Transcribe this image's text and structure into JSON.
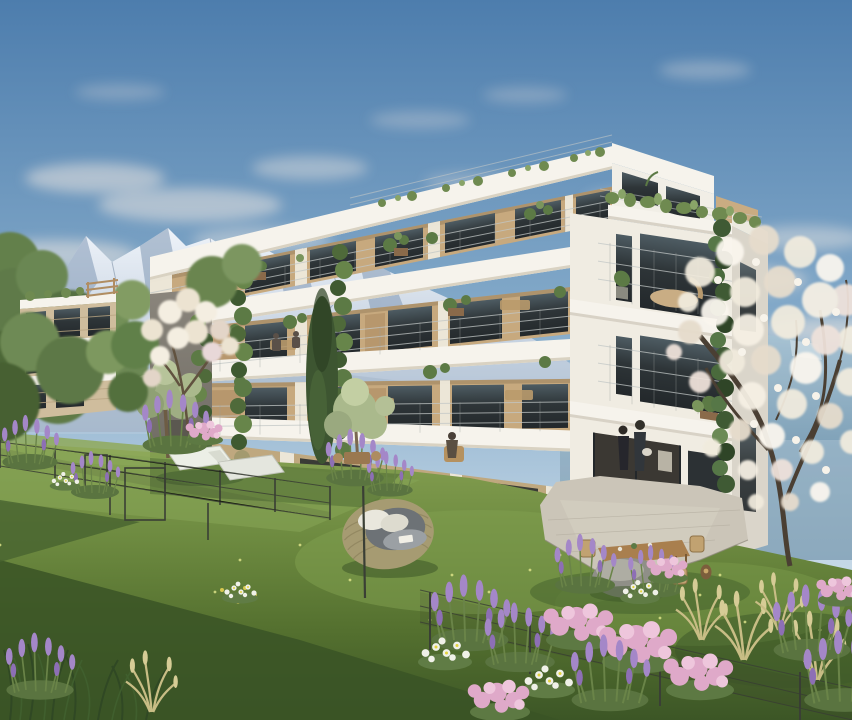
{
  "scene": {
    "description": "Architectural rendering of a modern four-storey apartment building with wood-clad balconies, rooftop terrace plants, an alpine snow mountain backdrop, a flowering meadow garden with wire fences, sun loungers, a rattan egg chair and a blossoming tree.",
    "palette": {
      "sky_top": "#4d7dad",
      "sky_mid": "#85abca",
      "sky_low": "#c4d7e6",
      "cloud": "#f6ece4",
      "snow": "#eef3f9",
      "mtn_shadow": "#8098b4",
      "mtn_right": "#7d9fb6",
      "facade_white": "#f6f3ec",
      "facade_tan": "#c7a97e",
      "facade_tan_dark": "#9c7f58",
      "facade_gray": "#7d7870",
      "window_dark": "#2e3538",
      "railing": "#c2c7c6",
      "ivy": "#466238",
      "leaf": "#5f7a47",
      "leaf_light": "#8aa468",
      "grass_light": "#86a152",
      "grass_mid": "#5f7c38",
      "grass_dark": "#3c5626",
      "blossom": "#f1ebdd",
      "lavender": "#a487c8",
      "pink": "#dfa9c9",
      "stone": "#cbc5b8",
      "wood": "#a97f4e",
      "rattan": "#a69b72"
    },
    "elements": [
      {
        "name": "sky",
        "label": "evening blue sky with wispy clouds"
      },
      {
        "name": "alps-mountain-range",
        "label": "snow covered alpine peaks"
      },
      {
        "name": "main-apartment-building",
        "label": "four storey white apartment building with balconies"
      },
      {
        "name": "green-facade-ivy",
        "label": "climbing ivy on facade corner"
      },
      {
        "name": "garden",
        "label": "meadow garden with lavender and wildflowers"
      },
      {
        "name": "egg-chair",
        "label": "rattan egg lounge chair with cushions"
      },
      {
        "name": "blossom-tree",
        "label": "white blossoming tree"
      }
    ]
  }
}
